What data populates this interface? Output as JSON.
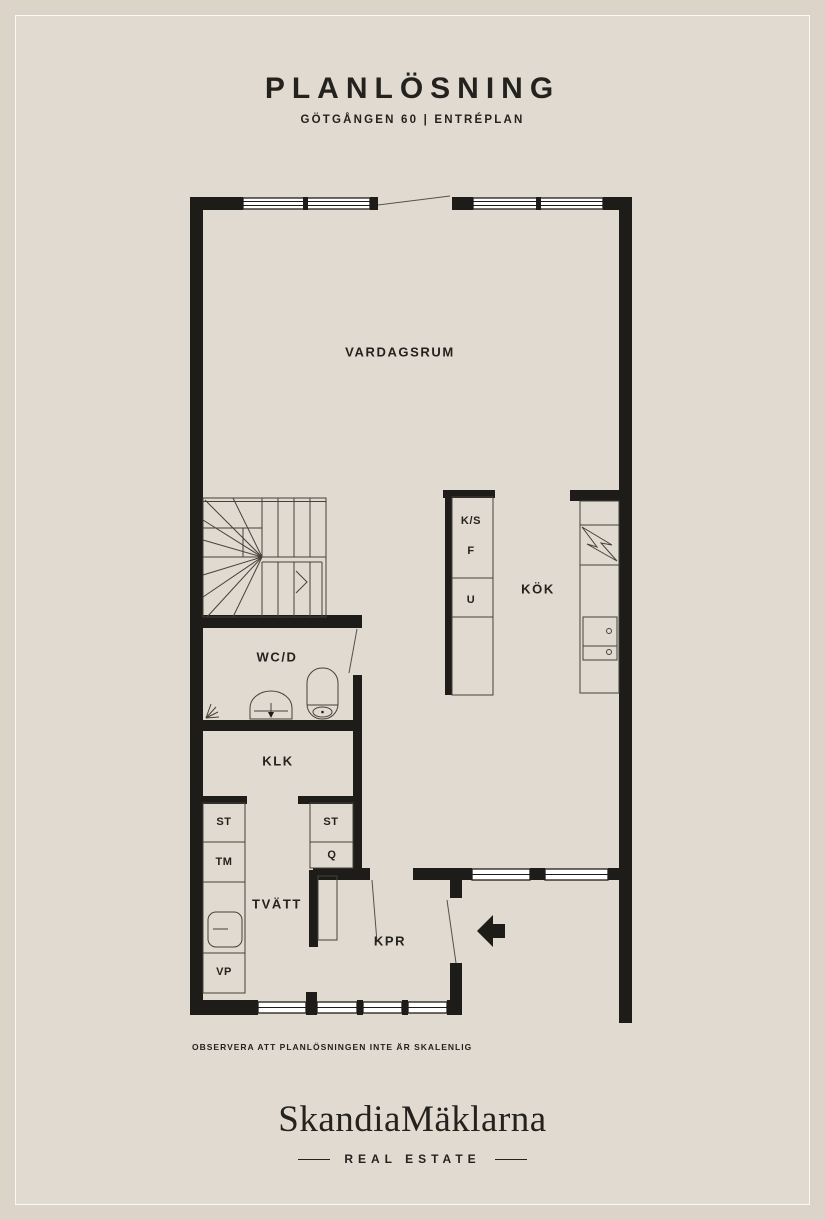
{
  "header": {
    "title": "PLANLÖSNING",
    "subtitle": "GÖTGÅNGEN 60  |  ENTRÉPLAN"
  },
  "rooms": {
    "vardagsrum": "VARDAGSRUM",
    "kok": "KÖK",
    "wcd": "WC/D",
    "klk": "KLK",
    "tvatt": "TVÄTT",
    "kpr": "KPR"
  },
  "fixtures": {
    "ks": "K/S",
    "f": "F",
    "u": "U",
    "st_left": "ST",
    "tm": "TM",
    "vp": "VP",
    "st_right": "ST",
    "q": "Q"
  },
  "footer": {
    "disclaimer": "OBSERVERA ATT PLANLÖSNINGEN INTE ÄR SKALENLIG",
    "logo": "SkandiaMäklarna",
    "logo_sub": "REAL ESTATE"
  },
  "colors": {
    "background": "#dcd4c8",
    "panel": "#e1dad0",
    "wall": "#1e1c19",
    "window": "#ffffff",
    "text": "#24221e"
  }
}
